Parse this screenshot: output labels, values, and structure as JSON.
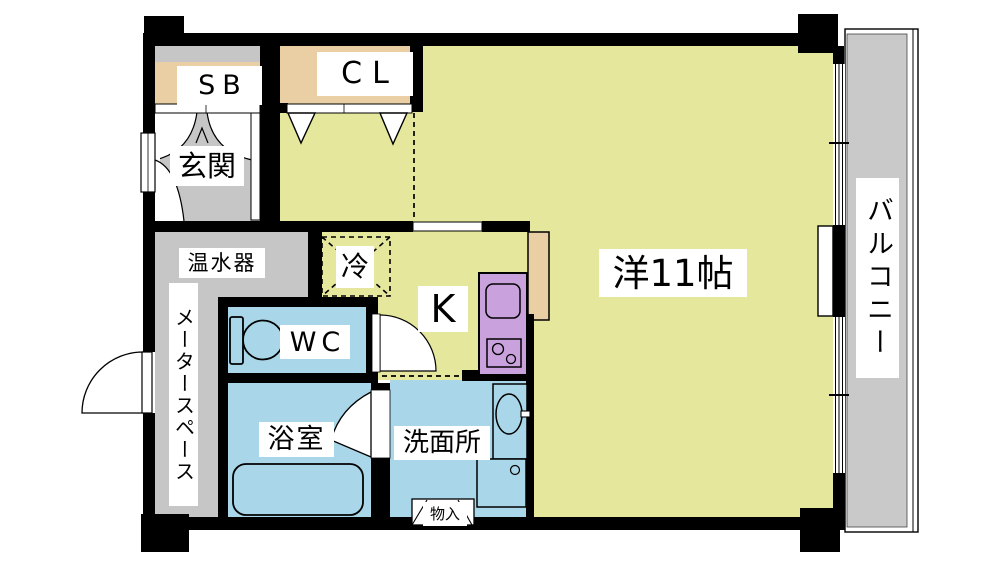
{
  "plan": {
    "type": "apartment-floorplan",
    "labels": {
      "entrance": "玄関",
      "shoe_box": "SB",
      "closet": "CL",
      "water_heater": "温水器",
      "meter_space": "メータースペース",
      "toilet": "WC",
      "bathroom": "浴室",
      "washroom": "洗面所",
      "kitchen": "K",
      "refrigerator": "冷",
      "storage": "物入",
      "western_room": "洋11帖",
      "balcony": "バルコニー"
    },
    "fixtures": [
      "toilet-icon",
      "bathtub-icon",
      "washbasin-icon",
      "washer-pan-icon",
      "kitchen-sink-icon",
      "stove-icon",
      "door-swing-icon",
      "folding-door-icon",
      "sliding-window-icon"
    ],
    "colors": {
      "wall": "#000000",
      "room_floor": "#e4e79c",
      "closet_tan": "#eacfa4",
      "wet_area_blue": "#a9d6e8",
      "kitchen_counter_purple": "#c9a2dd",
      "service_gray": "#c6c6c6",
      "balcony_gray": "#c9c9c9",
      "background": "#ffffff",
      "label_bg": "#ffffff"
    }
  }
}
